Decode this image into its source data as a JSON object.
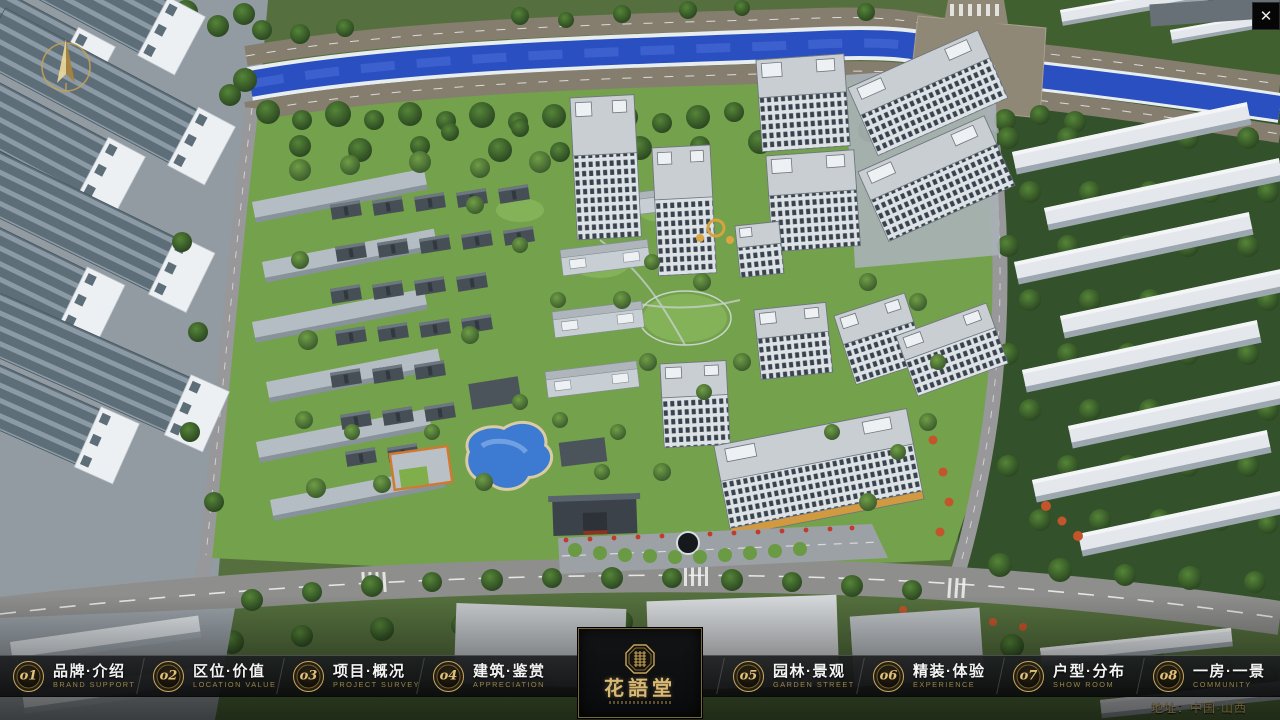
{
  "window": {
    "close_glyph": "✕"
  },
  "colors": {
    "accent_gold": "#c9a85e",
    "river_blue": "#2a4fc0",
    "lawn_green": "#74a14c",
    "road_grey": "#8e8e8c",
    "bar_background": "#0c0d0e"
  },
  "navbar": {
    "items": [
      {
        "num": "o1",
        "label": "品牌·介绍",
        "sub": "BRAND SUPPORT"
      },
      {
        "num": "o2",
        "label": "区位·价值",
        "sub": "LOCATION VALUE"
      },
      {
        "num": "o3",
        "label": "项目·概况",
        "sub": "PROJECT SURVEY"
      },
      {
        "num": "o4",
        "label": "建筑·鉴赏",
        "sub": "APPRECIATION"
      },
      {
        "num": "o5",
        "label": "园林·景观",
        "sub": "GARDEN STREET"
      },
      {
        "num": "o6",
        "label": "精装·体验",
        "sub": "EXPERIENCE"
      },
      {
        "num": "o7",
        "label": "户型·分布",
        "sub": "SHOW ROOM"
      },
      {
        "num": "o8",
        "label": "一房·一景",
        "sub": "COMMUNITY"
      }
    ],
    "logo": {
      "title": "花語堂"
    }
  },
  "footer": {
    "address": "地址：中国·山西"
  }
}
